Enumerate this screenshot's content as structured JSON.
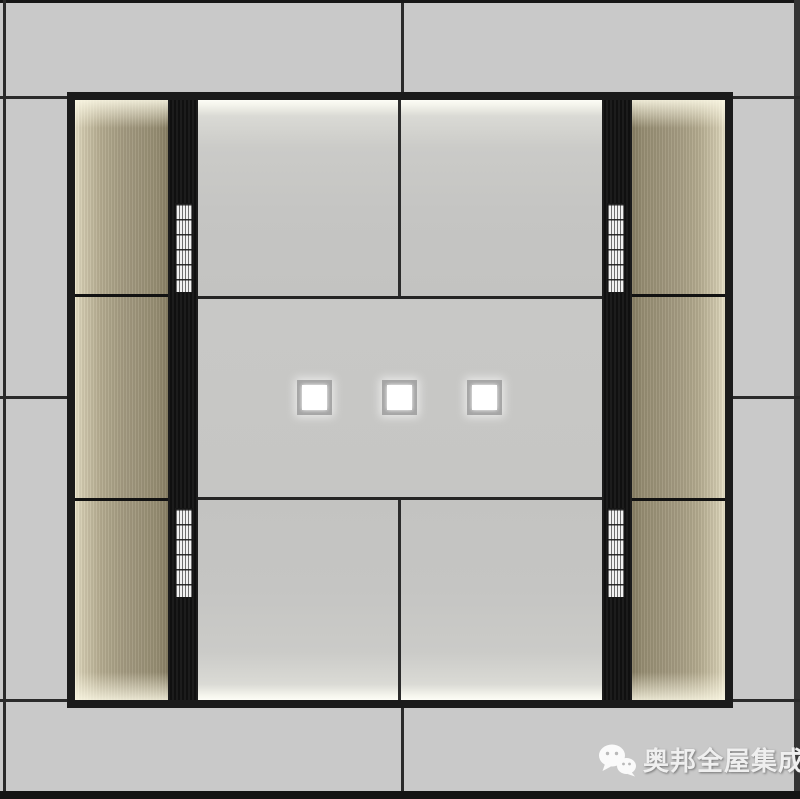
{
  "colors": {
    "margin_gray": "#c9c9c9",
    "line_dark": "#2a2a2a",
    "frame_black": "#1b1b1b",
    "wood_mid": "#a59c82",
    "grille_white": "#f2f2f2",
    "light_frame": "#a5a5a5",
    "light_white": "#ffffff",
    "watermark_color": "#efefef"
  },
  "downlights": [
    {
      "x": 297,
      "y": 380,
      "size": 35
    },
    {
      "x": 382,
      "y": 380,
      "size": 35
    },
    {
      "x": 467,
      "y": 380,
      "size": 35
    }
  ],
  "grilles": [
    {
      "x": 175,
      "y": 203
    },
    {
      "x": 175,
      "y": 508
    },
    {
      "x": 607,
      "y": 203
    },
    {
      "x": 607,
      "y": 508
    }
  ],
  "watermark": {
    "label": "奥邦全屋集成顶",
    "icon": "wechat-icon"
  }
}
